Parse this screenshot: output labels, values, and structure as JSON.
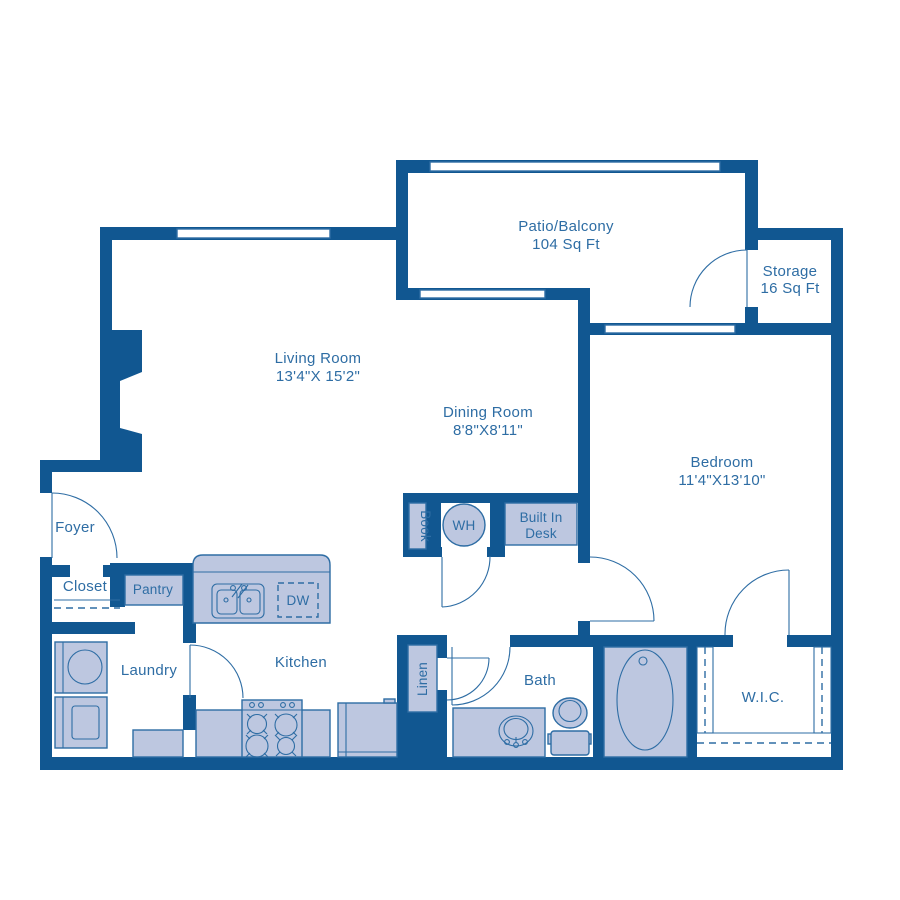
{
  "colors": {
    "wall": "#115791",
    "fixture_fill": "#bdc7e0",
    "line": "#2e6da4",
    "text": "#2e6da4",
    "background": "#ffffff"
  },
  "rooms": {
    "patio": {
      "name": "Patio/Balcony",
      "area": "104 Sq Ft"
    },
    "storage": {
      "name": "Storage",
      "area": "16 Sq Ft"
    },
    "living": {
      "name": "Living Room",
      "dimensions": "13'4\"X 15'2\""
    },
    "dining": {
      "name": "Dining Room",
      "dimensions": "8'8\"X8'11\""
    },
    "bedroom": {
      "name": "Bedroom",
      "dimensions": "11'4\"X13'10\""
    },
    "foyer": {
      "name": "Foyer"
    },
    "closet": {
      "name": "Closet"
    },
    "pantry": {
      "name": "Pantry"
    },
    "laundry": {
      "name": "Laundry"
    },
    "kitchen": {
      "name": "Kitchen"
    },
    "bath": {
      "name": "Bath"
    },
    "wic": {
      "name": "W.I.C."
    },
    "linen": {
      "name": "Linen"
    }
  },
  "fixtures": {
    "book_shelf": {
      "label": "Book"
    },
    "water_heater": {
      "label": "WH"
    },
    "dishwasher": {
      "label": "DW"
    },
    "built_in_desk": {
      "label_line1": "Built In",
      "label_line2": "Desk"
    }
  }
}
